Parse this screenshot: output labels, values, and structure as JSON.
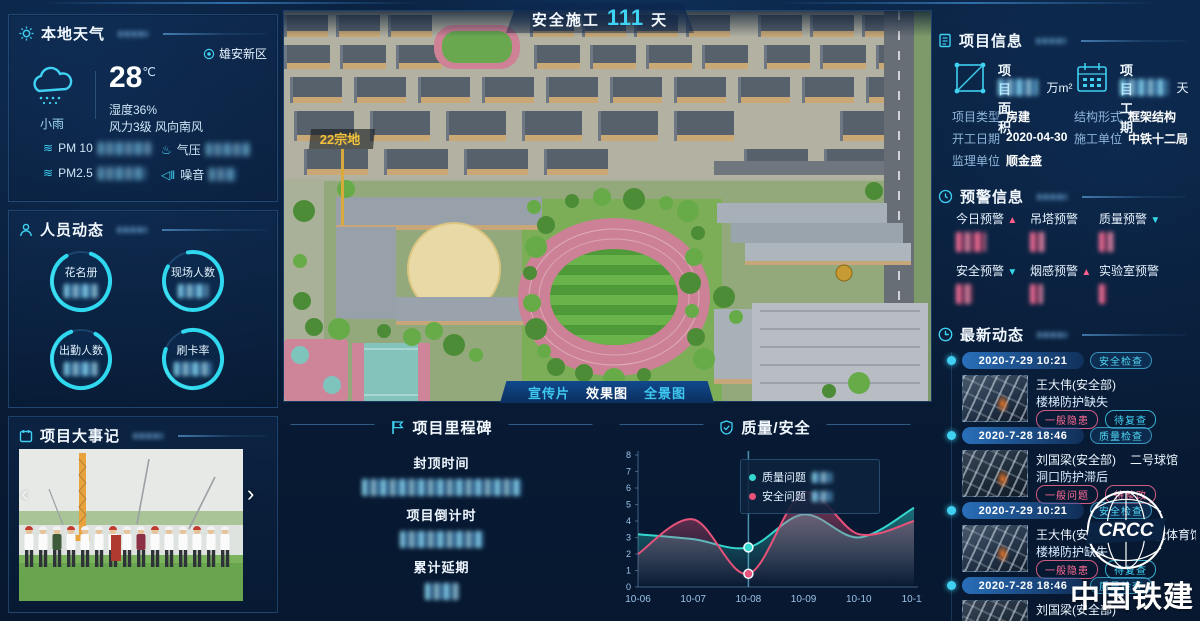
{
  "header": {
    "label": "安全施工",
    "days": "111",
    "unit": "天"
  },
  "weather": {
    "title": "本地天气",
    "location": "雄安新区",
    "condition": "小雨",
    "temperature": "28",
    "temp_unit": "℃",
    "humidity": "湿度36%",
    "wind": "风力3级 风向南风",
    "metrics": [
      {
        "label": "PM 10"
      },
      {
        "label": "气压"
      },
      {
        "label": "PM2.5"
      },
      {
        "label": "噪音"
      }
    ]
  },
  "personnel": {
    "title": "人员动态",
    "rings": [
      {
        "label": "花名册"
      },
      {
        "label": "现场人数"
      },
      {
        "label": "出勤人数"
      },
      {
        "label": "刷卡率"
      }
    ]
  },
  "events": {
    "title": "项目大事记",
    "prev": "‹",
    "next": "›"
  },
  "main_view": {
    "plot_label": "22宗地",
    "tabs": [
      {
        "label": "宣传片",
        "active": false
      },
      {
        "label": "效果图",
        "active": true
      },
      {
        "label": "全景图",
        "active": false
      }
    ]
  },
  "milestone": {
    "title": "项目里程碑",
    "items": [
      {
        "label": "封顶时间"
      },
      {
        "label": "项目倒计时"
      },
      {
        "label": "累计延期"
      }
    ]
  },
  "quality_safety": {
    "title": "质量/安全",
    "chart_data": {
      "type": "line",
      "x": [
        "10-06",
        "10-07",
        "10-08",
        "10-09",
        "10-10",
        "10-11"
      ],
      "series": [
        {
          "name": "质量问题",
          "color": "#35d8cf",
          "values": [
            3.2,
            2.9,
            2.4,
            4.4,
            3.0,
            4.8
          ]
        },
        {
          "name": "安全问题",
          "color": "#e8527a",
          "values": [
            2.0,
            4.1,
            0.8,
            5.7,
            3.2,
            4.0
          ]
        }
      ],
      "ylim": [
        0,
        8
      ],
      "y_ticks": [
        0,
        1,
        2,
        3,
        4,
        5,
        6,
        7,
        8
      ],
      "highlight_x": "10-08",
      "smooth": true,
      "area": true,
      "grid": false,
      "legend_position": "tooltip"
    }
  },
  "project_info": {
    "title": "项目信息",
    "area_label": "项目面积",
    "area_unit": "万m²",
    "duration_label": "项目工期",
    "duration_unit": "天",
    "rows": [
      {
        "label": "项目类型",
        "value": "房建"
      },
      {
        "label": "结构形式",
        "value": "框架结构"
      },
      {
        "label": "开工日期",
        "value": "2020-04-30"
      },
      {
        "label": "施工单位",
        "value": "中铁十二局"
      },
      {
        "label": "监理单位",
        "value": "顺金盛"
      }
    ]
  },
  "alerts": {
    "title": "预警信息",
    "items": [
      {
        "label": "今日预警",
        "trend": "up"
      },
      {
        "label": "吊塔预警",
        "trend": "none"
      },
      {
        "label": "质量预警",
        "trend": "down"
      },
      {
        "label": "安全预警",
        "trend": "down"
      },
      {
        "label": "烟感预警",
        "trend": "up"
      },
      {
        "label": "实验室预警",
        "trend": "none"
      }
    ]
  },
  "feed": {
    "title": "最新动态",
    "entries": [
      {
        "date": "2020-7-29 10:21",
        "category": "安全检查",
        "name": "王大伟(安全部)",
        "location": "",
        "desc": "楼梯防护缺失",
        "tags": [
          {
            "label": "一般隐患",
            "type": "pink"
          },
          {
            "label": "待复查",
            "type": "cyan"
          }
        ]
      },
      {
        "date": "2020-7-28 18:46",
        "category": "质量检查",
        "name": "刘国梁(安全部)",
        "location": "二号球馆",
        "desc": "洞口防护滞后",
        "tags": [
          {
            "label": "一般问题",
            "type": "pink"
          },
          {
            "label": "待整改",
            "type": "pink"
          }
        ]
      },
      {
        "date": "2020-7-29 10:21",
        "category": "安全检查",
        "name": "王大伟(安全部)",
        "location": "多功能体育馆",
        "desc": "楼梯防护缺失",
        "tags": [
          {
            "label": "一般隐患",
            "type": "pink"
          },
          {
            "label": "待复查",
            "type": "cyan"
          }
        ]
      },
      {
        "date": "2020-7-28 18:46",
        "category": "质量检查",
        "name": "刘国梁(安全部)",
        "location": "",
        "desc": "",
        "tags": []
      }
    ]
  },
  "logo": {
    "abbr": "CRCC",
    "text": "中国铁建"
  },
  "colors": {
    "accent": "#3fd0f2",
    "pink": "#e8527a",
    "teal": "#35d8cf",
    "bg": "#081c36",
    "warn_value": "#ff5f8a"
  }
}
